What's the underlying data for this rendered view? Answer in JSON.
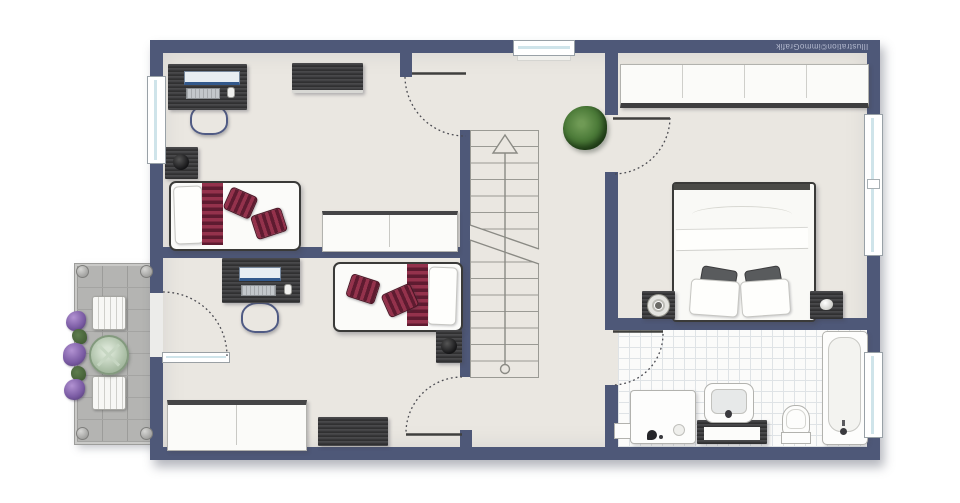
{
  "watermark": {
    "text": "Illustration©immoGrafik"
  },
  "plan": {
    "type": "residential-floor-plan",
    "rooms": [
      {
        "id": "room-top-left",
        "kind": "kids-bedroom",
        "furniture": [
          "desk",
          "monitor",
          "keyboard",
          "mouse",
          "office-chair",
          "dresser",
          "nightstand",
          "lamp",
          "single-bed",
          "pillow",
          "striped-runner",
          "striped-pillow",
          "striped-pillow",
          "sideboard"
        ],
        "windows": 1,
        "doors": 1
      },
      {
        "id": "room-bottom-left",
        "kind": "kids-bedroom",
        "furniture": [
          "desk",
          "monitor",
          "keyboard",
          "mouse",
          "office-chair",
          "single-bed",
          "pillow",
          "striped-runner",
          "striped-pillow",
          "striped-pillow",
          "nightstand",
          "lamp",
          "sideboard",
          "dresser"
        ],
        "doors": 2,
        "balcony_access": true
      },
      {
        "id": "hallway",
        "kind": "stair-landing",
        "furniture": [
          "staircase",
          "potted-plant"
        ],
        "windows": 1
      },
      {
        "id": "master-bedroom",
        "kind": "bedroom",
        "furniture": [
          "wardrobe",
          "double-bed",
          "dark-pillow",
          "dark-pillow",
          "white-pillow",
          "white-pillow",
          "nightstand-left",
          "round-lamp",
          "nightstand-right",
          "decor-object"
        ],
        "windows": 1,
        "doors": 1
      },
      {
        "id": "bathroom",
        "kind": "bathroom",
        "furniture": [
          "shower",
          "waste-bin",
          "vanity",
          "washbasin",
          "toilet",
          "bathtub"
        ],
        "windows": 1,
        "doors": 1
      },
      {
        "id": "balcony",
        "kind": "balcony",
        "furniture": [
          "garden-chair",
          "garden-chair",
          "round-table",
          "flower-planters"
        ]
      }
    ],
    "doors_total": 5,
    "windows_total": 4,
    "colors": {
      "wall": "#4e5878",
      "floor": "#eae7e1",
      "bathroom_tile": "#fbfbfa",
      "balcony_paver": "#b4b4b2",
      "accent_red": "#8e2d45",
      "plant_green": "#3f652f",
      "table_green": "#a9bda4",
      "watermark_text": "#b4bacf"
    }
  }
}
